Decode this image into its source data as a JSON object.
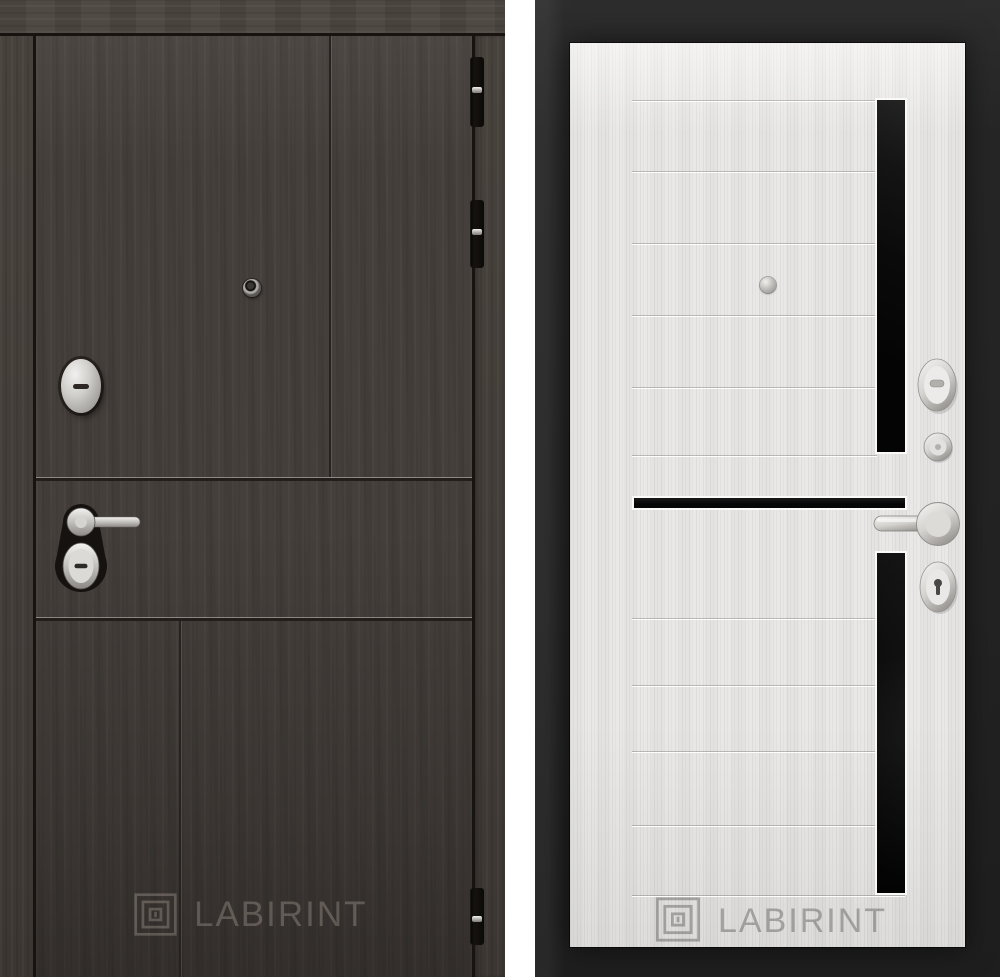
{
  "brand": {
    "name": "LABIRINT"
  },
  "theme": {
    "page-bg": "#ffffff",
    "wenge-leaf": "#453f3b",
    "wenge-frame": "#4c4641",
    "wenge-gap": "#17130f",
    "right-backdrop": "#262626",
    "white-leaf": "#e9e8e6",
    "glass-black": "#070707",
    "left-watermark": "rgba(213,205,194,0.27)",
    "right-watermark": "rgba(72,72,70,0.40)"
  },
  "left_door": {
    "view": "exterior-dark-wenge",
    "logo_text": "LABIRINT",
    "hardware": [
      "hinge",
      "hinge",
      "hinge",
      "peephole",
      "key-cylinder-escutcheon",
      "lever-handle",
      "lock-cylinder"
    ]
  },
  "right_door": {
    "view": "interior-white-sandal",
    "logo_text": "LABIRINT",
    "glass_inserts": [
      "vertical-top-strip",
      "horizontal-middle-strip",
      "vertical-bottom-strip"
    ],
    "hardware": [
      "peephole",
      "thumbturn-escutcheon",
      "lock-knob",
      "lever-handle",
      "keyhole-escutcheon"
    ]
  }
}
